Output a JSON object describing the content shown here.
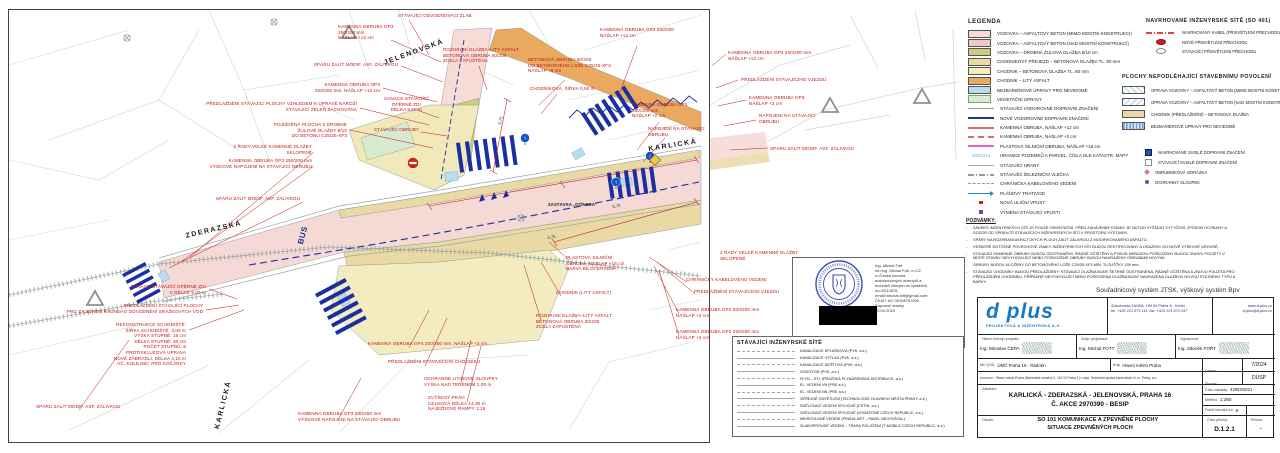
{
  "drawing": {
    "street_labels": [
      "JELENOVSKÁ",
      "ZDERAZSKÁ",
      "KARLICKÁ",
      "KARLICKÁ"
    ],
    "stop_label": "ZASTÁVKA „OTÍNSKÁ“",
    "bus_marking": "BUS",
    "dimensions": [
      "5,70",
      "3,75",
      "5,70"
    ],
    "annotations": [
      "STÁVAJÍCÍ ODVODŇOVACÍ ŽLAB",
      "KAMENNÁ OBRUBA OP3\n250/200 mm\nNÁŠLAP +12 cm",
      "SPÁRU ZALÍT MODIF. ASF. ZÁLIVKOU",
      "KAMENNÁ OBRUBA OP3\n250/200 mm, NÁŠLAP +12 cm",
      "PŘEDLÁŽDĚNÍ STÁVAJÍCÍ PLOCHY VZHLEDEM K ÚPRAVĚ NÁROŽÍ\nSTÁVAJÍCÍ ZELEŇ ZACHOVÁNA",
      "POJÍŽDĚNÁ PLOCHA Z DROBNÉ\nŽULOVÉ DLAŽBY 8/10\nDO BETONU C25/25-XF3",
      "2 ŘADY VELKÉ KAMENNÉ DLAŽBY\nSKLOPENÉ",
      "KAMENNÁ OBRUBA OP3 250/200 mm\nVÝŠKOVÉ NAPOJENÍ NA STÁVAJÍCÍ OBRUBU",
      "SPÁRU ZALÍT MODIF. ASF. ZÁLIVKOU",
      "SANACE STÁVAJÍCÍ\nOPĚRNÉ ZDI\nDÉLKA 8,50 m",
      "STÁVAJÍCÍ OBRUBY",
      "ROZHRANÍ DLAŽBA–LITÝ ASFALT\nBETONOVÁ OBRUBA 50/200\nZCELA ZAPUŠTĚNÁ",
      "BETONOVÁ OBRUBA 60/200\nDO BETONOVÉHO LOŽE C25/25-XF3\nNÁŠLAP +8 cm",
      "CHODNÍKOVÁ, ŠÍŘKA 0,50 m",
      "KAMENNÁ OBRUBA OP3 250/200\nNÁŠLAP +12 cm",
      "KAMENNÁ OBRUBA OP3\n250/200 mm\nNÁŠLAP +2 cm",
      "NAPOJENÍ NA STÁVAJÍCÍ\nOBRUBU",
      "KAMENNÁ OBRUBA OP3 250/200 mm\nNÁŠLAP +12 cm",
      "PŘEDLÁŽDĚNÍ STÁVAJÍCÍHO VJEZDU",
      "KAMENNÁ OBRUBA OP3\nNÁŠLAP +2 cm",
      "NAPOJENÍ NA STÁVAJÍCÍ\nOBRUBU",
      "SPÁRU ZALÍT MODIF. ASF. ZÁLIVKOU",
      "SANACE STÁVAJÍCÍ OPĚRNÉ ZDI\nV DÉLCE 5,00 m",
      "PŘEDLÁŽDĚNÍ STÁVAJÍCÍ PLOCHY\nPRO ZAJIŠTĚNÍ ŘÁDNÉHO ODVODNĚNÍ SRÁŽKOVÝCH VOD",
      "REKONSTRUKCE SCHODIŠTĚ:\nŠÍŘKA SCHODIŠTĚ: 3,00 m\nVÝŠKA STUPNĚ: 16 cm\nDÉLKA STUPNĚ: 30 cm\nPOČET STUPŇŮ: 8\nPROTISKLUZOVÁ ÚPRAVA\nNOVÉ ZÁBRADLÍ, DÉLKA 4,15 m\nVČ. KOLEJNIC PRO KOČÁRKY",
      "SPÁRU ZALÍT MODIF. ASF. ZÁLIVKOU",
      "KAMENNÁ OBRUBA OP3 200/250 mm\nVÝŠKOVÉ NAPOJENÍ NA STÁVAJÍCÍ OBRUBU",
      "KAMENNÁ OBRUBA OP4 200/250 mm, NÁŠLAP +2 cm",
      "PŘEDLÁŽDĚNÍ STÁVAJÍCÍHO CHODNÍKU",
      "OCHRANNÉ LITINOVÉ SLOUPKY\nVÝŠKA NAD TERÉNEM 1,00 m",
      "ZVÝŠENÝ PRÁH\nCELKOVÁ DÉLKA 14,30 m\nNÁJEZDOVÉ RAMPY 1:15",
      "PLASTOVÁ SILNIČNÍ\nOBRUBA, NÁŠLAP +16 cm\nBARVA BÍLOČERVENÁ",
      "CHODNÍK (LITÝ ASFALT)",
      "ROZHRANÍ DLAŽBA–LITÝ ASFALT\nBETONOVÁ OBRUBA 50/200\nZCELA ZAPUŠTĚNÁ",
      "CHRÁNIČKY KABELOVÉHO VEDENÍ",
      "PŘEDLÁŽDĚNÍ STÁVAJÍCÍHO VJEZDU",
      "KAMENNÁ OBRUBA OP4 200/200 mm\nNÁŠLAP +2 cm",
      "KAMENNÁ OBRUBA OP3 250/200 mm\nNÁŠLAP +2 cm",
      "2 ŘADY VELKÉ KAMENNÉ DLAŽBY\nSKLOPENÉ"
    ]
  },
  "legend": {
    "title": "LEGENDA",
    "parcel_sample": "2905/214",
    "items": [
      "VOZOVKA – ASFALTOVÝ BETON (MIMO MOSTNÍ KONSTRUKCI)",
      "VOZOVKA – ASFALTOVÝ BETON (NAD MOSTNÍ KONSTRUKCÍ)",
      "VOZOVKA – DROBNÁ ŽULOVÁ DLAŽBA 8/10 cm",
      "CHODNÍKOVÝ PŘEJEZD – BETONOVÁ DLAŽBA TL. 80 mm",
      "CHODNÍK – BETONOVÁ DLAŽBA TL. 60 mm",
      "CHODNÍK – LITÝ ASFALT",
      "BEZBARIÉROVÉ ÚPRAVY PRO NEVIDOMÉ",
      "VEGETAČNÍ ÚPRAVY",
      "STÁVAJÍCÍ VODOROVNÉ DOPRAVNÍ ZNAČENÍ",
      "NOVÉ VODOROVNÉ DOPRAVNÍ ZNAČENÍ",
      "KAMENNÁ OBRUBA, NÁŠLAP +12 cm",
      "KAMENNÁ OBRUBA, NÁŠLAP +2 cm",
      "PLASTOVÁ SILNIČNÍ OBRUBA, NÁŠLAP +16 cm",
      "HRANICE POZEMKŮ A PARCEL, ČÍSLA DLE KATASTR. MAPY",
      "STÁVAJÍCÍ HRANY",
      "STÁVAJÍCÍ ŽELEZNIČNÍ VLEČKA",
      "CHRÁNIČKA KABELOVÉHO VEDENÍ",
      "PLÁŇOVÝ TRATIVOD",
      "NOVÁ ULIČNÍ VPUST",
      "VÝMĚNA STÁVAJÍCÍ VPUSTI"
    ]
  },
  "proposed_networks": {
    "title": "NAVRHOVANÉ INŽENÝRSKÉ SÍTĚ (SO 401)",
    "items": [
      "NAVRHOVANÝ KABEL (PŘISVĚTLENÍ PŘECHODU)",
      "NOVÉ PŘISVĚTLENÍ PŘECHODU",
      "STÁVAJÍCÍ PŘISVĚTLENÍ PŘECHODU"
    ]
  },
  "no_permit_areas": {
    "title": "PLOCHY NEPODLÉHAJÍCÍ STAVEBNÍMU POVOLENÍ",
    "items": [
      "OPRAVA VOZOVKY – ASFALTOVÝ BETON (MIMO MOSTNÍ KONSTRUKCI)",
      "OPRAVA VOZOVKY – ASFALTOVÝ BETON (NAD MOSTNÍ KONSTRUKCÍ)",
      "CHODNÍK (PŘEDLÁŽDĚNÍ) – BETONOVÁ DLAŽBA",
      "BEZBARIÉROVÉ ÚPRAVY PRO NEVIDOMÉ"
    ]
  },
  "signs_legend": {
    "items": [
      "NAVRHOVANÉ SVISLÉ DOPRAVNÍ ZNAČENÍ",
      "STÁVAJÍCÍ SVISLÉ DOPRAVNÍ ZNAČENÍ",
      "OBRUBNÍKOVÁ ODRAZKA",
      "OCHRANNÝ SLOUPEK"
    ]
  },
  "notes": {
    "title": "POZNÁMKY:",
    "items": [
      "ZÁKRES INŽENÝRSKÝCH SÍTÍ JE POUZE ORIENTAČNÍ. PŘED ZAHÁJENÍM STAVBY JE NUTNO VYŽÁDAT VYTYČENÍ, ZPŮSOB OCHRANY A DOZOR OD SPRÁVCŮ STÁVAJÍCÍCH INŽENÝRSKÝCH SÍTÍ V PROSTORU VÝSTAVBY.",
      "SPÁRY NA ROZHRANÍ ASFALTOVÝCH PLOCH ZALÍT ZÁLIVKOU Z MODIFIKOVANÉHO ASFALTU.",
      "VEŠKERÉ DOTČENÉ POVRCHOVÉ ZNAKY INŽENÝRSKÝCH SÍTÍ BUDOU REKTIFIKOVÁNY A OSAZENY DO NOVÉ VÝŠKOVÉ ÚROVNĚ.",
      "STÁVAJÍCÍ KAMENNÉ OBRUBY BUDOU ODSTRANĚNY, ŘÁDNĚ OČIŠTĚNY A POKUD NEBUDOU POŠKOZENY BUDOU ZNOVU POUŽITY V MÍSTĚ STAVBY. NEVYHOVUJÍCÍ NEBO POŠKOZENÉ OBRUBY BUDOU NAHRAZENY OBRUBAMI NOVÝMI.",
      "OBRUBY BUDOU ULOŽENY DO BETONOVÉHO LOŽE C25/25-XF3 MIN. TLOUŠŤKY 150 mm.",
      "STÁVAJÍCÍ CHODNÍKY BUDOU PŘEDLÁŽDĚNY: STÁVAJÍCÍ DLAŽBA BUDE ŠETRNĚ ODSTRANĚNA, ŘÁDNĚ OČIŠTĚNA A ZNOVU POUŽITA PRO PŘEDLÁŽDĚNÍ CHODNÍKU. PŘÍPADNĚ NEVYHOVUJÍCÍ NEBO POŠKOZENÁ DLAŽBA BUDE NAHRAZENA DLAŽBOU NOVOU STEJNÉHO TYPU A BARVY."
    ]
  },
  "coord_note": "Souřadnicový systém JTSK, výškový systém Bpv",
  "stamp": {
    "lines": [
      "Ing. Michal Fott",
      "cn=Ing. Michal Fott, c=CZ,",
      "o=Česká komora",
      "autorizovaných inženýrů a",
      "techniků činných ve výstavbě,",
      "ou=0012876,",
      "email=michal.fott@gmail.com",
      "ČKAIT AO 0012876 I000",
      "Dopravní stavby",
      "20.09.2024"
    ]
  },
  "existing_networks": {
    "title": "STÁVAJÍCÍ INŽENÝRSKÉ SÍTĚ",
    "items": [
      "KANALIZACE SPLAŠKOVÁ (PVK, a.s.)",
      "KANALIZACE VÝTLAK (PVK, a.s.)",
      "KANALIZACE DEŠŤOVÁ (PVK, a.s.)",
      "VODOVOD (PVK, a.s.)",
      "PLYN – STL (PRAŽSKÁ PLYNÁRENSKÁ DISTRIBUCE, a.s.)",
      "EL. VEDENÍ VN (PRE a.s.)",
      "EL. VEDENÍ NN (PRE a.s.)",
      "VEŘEJNÉ OSVĚTLENÍ (TECHNOLOGIE HLAVNÍHO MĚSTA PRAHY, a.s.)",
      "SDĚLOVACÍ VEDENÍ SPOJOVÉ (CETIN, a.s.)",
      "SDĚLOVACÍ VEDENÍ SPOJOVÉ (VODAFONE CZECH REPUBLIC, a.s.)",
      "MIKROVLNNÉ VEDENÍ (PRAHA.NET – PAVEL NECHVÁTAL)",
      "SLABOPROUDÉ VEDENÍ – TRASA POLOŽENÍ (T-MOBILE CZECH REPUBLIC, a.s.)"
    ]
  },
  "title_block": {
    "company": "d plus",
    "company_sub": "PROJEKTOVÁ A INŽENÝRSKÁ A.S.",
    "address": "Sokolovská 16/45A, 186 00 Praha 8 - Karlín",
    "phones": "tel. +420 221 873 111, fax. +420 221 873 247",
    "web": "www.d-plus.cz",
    "email": "d-plus@d-plus.cz",
    "chief_label": "Hlavní inženýr projektu:",
    "chief": "Ing. Miroslav ČEPA",
    "resp_label": "Zodp. projektant:",
    "resp": "Ing. Michal FOTT",
    "made_label": "Vypracoval:",
    "made": "Ing. Zdeněk FOŘT",
    "mu_label": "MÚ (OÚ):",
    "mu": "ÚMČ Praha 16 - Radotín",
    "kraj_label": "Kraj:",
    "kraj": "Hlavní město Praha",
    "datum_label": "Datum:",
    "datum": "7/2024",
    "investor_label": "Investor:",
    "investor": "Hlavní město Praha (Mariánské náměstí 2, 110 00 Praha 1) v zast. Technická správa komunikací hl. m. Prahy, a.s.",
    "stupen_label": "Stupeň:",
    "stupen": "DUSP",
    "zakazka_label": "Zakázka:",
    "zakazka_line1": "KARLICKÁ - ZDERAZSKÁ - JELENOVSKÁ, PRAHA 16",
    "zakazka_line2": "Č. AKCE 2970390 - BESIP",
    "cislo_zakazky_label": "Číslo zakázky:",
    "cislo_zakazky": "42063/2021",
    "meritko_label": "Měřítko:",
    "meritko": "1:250",
    "formaty_label": "Počet formátů A4:",
    "formaty": "8",
    "kopie_label": "Č. kopie:",
    "obsah_label": "Obsah:",
    "obsah_line1": "SO 101 KOMUNIKACE A ZPEVNĚNÉ PLOCHY",
    "obsah_line2": "SITUACE ZPEVNĚNÝCH PLOCH",
    "priloha_label": "Číslo přílohy:",
    "priloha": "D.1.2.1",
    "revize_label": "Revize:",
    "revize": "–"
  }
}
